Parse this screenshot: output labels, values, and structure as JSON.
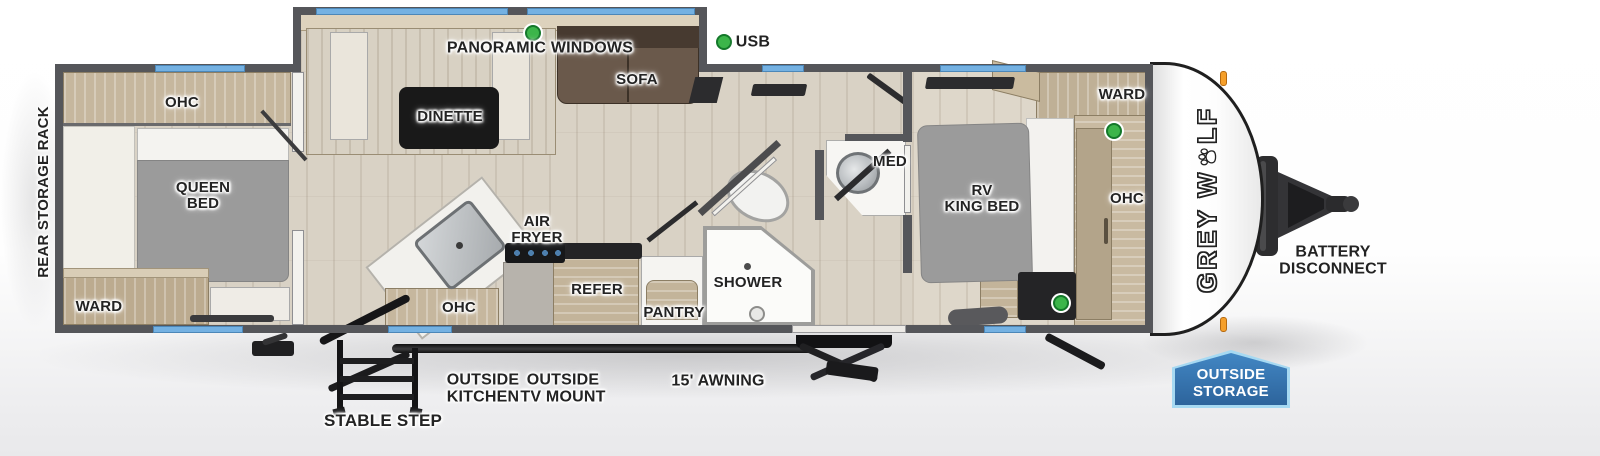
{
  "colors": {
    "wall": "#55565a",
    "window_blue": "#74b1e2",
    "usb_indicator_green": "#3cb54a",
    "badge_blue": "#2d649c",
    "badge_border_blue": "#a6d9f2",
    "marker_light_orange": "#f59f2a",
    "floor_wood": "#d9d2c5",
    "cabinet_wood": "#c3b49a",
    "sofa_brown": "#66554a",
    "bed_gray": "#9b9b9b"
  },
  "brand": {
    "prefix": "GREY W",
    "suffix": "LF"
  },
  "exterior": {
    "rear_storage_rack": "REAR STORAGE RACK",
    "stable_step": "STABLE STEP",
    "outside_kitchen": [
      "OUTSIDE",
      "KITCHEN"
    ],
    "outside_tv_mount": [
      "OUTSIDE",
      "TV MOUNT"
    ],
    "awning": "15' AWNING",
    "outside_storage": [
      "OUTSIDE",
      "STORAGE"
    ],
    "battery_disconnect": [
      "BATTERY",
      "DISCONNECT"
    ],
    "usb": "USB"
  },
  "rooms": {
    "rear_bedroom": {
      "ohc": "OHC",
      "queen_bed": [
        "QUEEN",
        "BED"
      ],
      "ward": "WARD"
    },
    "slideout": {
      "panoramic_windows": "PANORAMIC WINDOWS",
      "dinette": "DINETTE",
      "sofa": "SOFA"
    },
    "kitchen": {
      "air_fryer": [
        "AIR",
        "FRYER"
      ],
      "ohc": "OHC",
      "refer": "REFER",
      "pantry": "PANTRY"
    },
    "bathroom": {
      "shower": "SHOWER",
      "med": "MED"
    },
    "front_bedroom": {
      "rv_king_bed": [
        "RV",
        "KING BED"
      ],
      "ward": "WARD",
      "ohc": "OHC"
    }
  }
}
